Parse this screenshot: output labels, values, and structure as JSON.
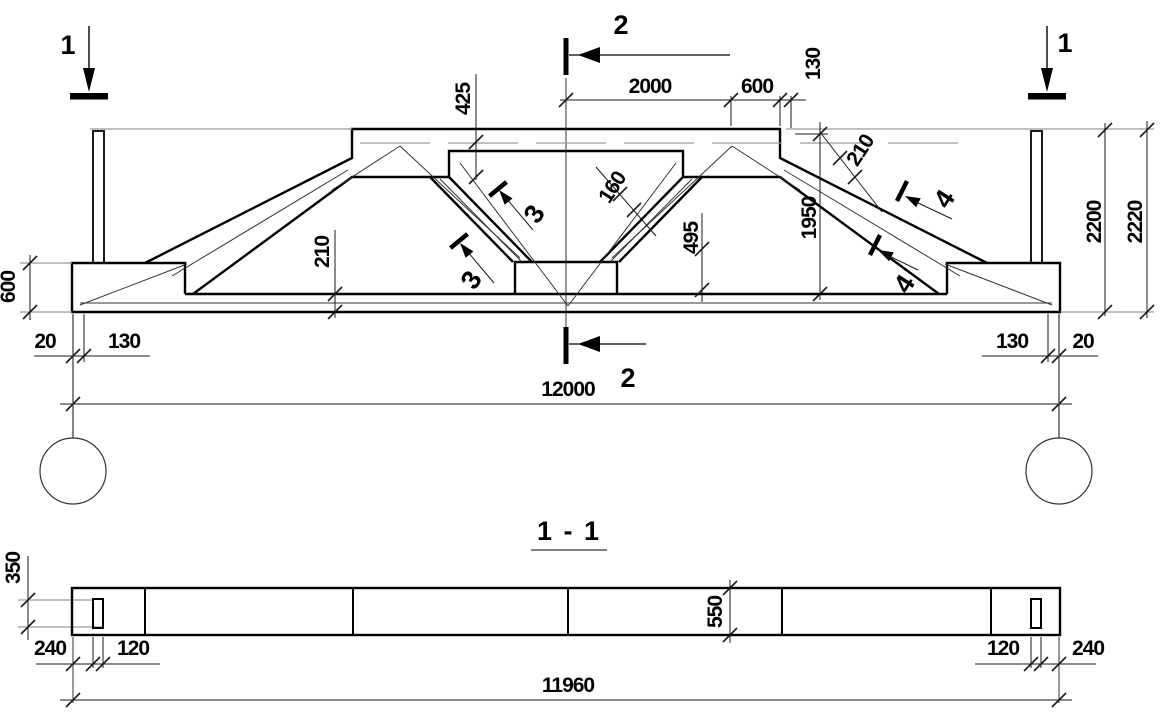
{
  "drawing": {
    "section_view_title": "1 - 1",
    "markers": {
      "m1_left": "1",
      "m1_right": "1",
      "m2_top": "2",
      "m2_bottom": "2",
      "m3_upper": "3",
      "m3_lower": "3",
      "m4_upper": "4",
      "m4_lower": "4"
    },
    "elevation": {
      "dim_2000": "2000",
      "dim_600_top": "600",
      "dim_130_top": "130",
      "dim_425": "425",
      "dim_160": "160",
      "dim_495": "495",
      "dim_1950": "1950",
      "dim_210_slope": "210",
      "dim_2200": "2200",
      "dim_2220": "2220",
      "dim_600_left": "600",
      "dim_210_bottom": "210",
      "dim_20_left": "20",
      "dim_130_left": "130",
      "dim_130_right": "130",
      "dim_20_right": "20",
      "dim_span": "12000"
    },
    "section_1_1": {
      "dim_350": "350",
      "dim_550": "550",
      "dim_240_left": "240",
      "dim_120_left": "120",
      "dim_120_right": "120",
      "dim_240_right": "240",
      "dim_length": "11960"
    },
    "colors": {
      "line": "#000000",
      "dim_line": "#1a1a1a",
      "light_line": "#9a9a9a"
    }
  }
}
